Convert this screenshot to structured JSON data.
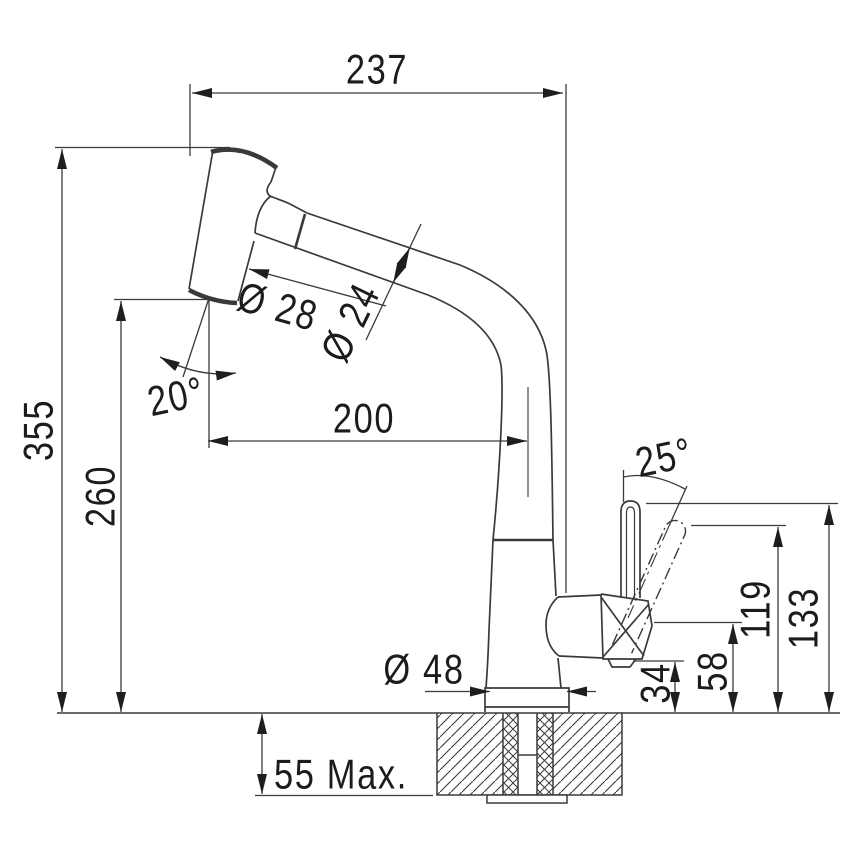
{
  "figure": {
    "subject": "pull-out-faucet-dimension-drawing",
    "background": "#ffffff",
    "line_color": "#3a3a3a",
    "text_color": "#1c1c1c"
  },
  "labels": {
    "overall_width": "237",
    "overall_height": "355",
    "spray_outlet_height": "260",
    "spout_reach": "200",
    "spray_head_angle": "20°",
    "spray_head_diameter": "Ø 28",
    "spout_tube_diameter": "Ø 24",
    "lever_swing_angle": "25°",
    "lever_height": "119",
    "lever_max_height": "133",
    "valve_center_height": "58",
    "valve_bottom_height": "34",
    "base_diameter": "Ø 48",
    "deck_max_thickness": "55 Max."
  }
}
